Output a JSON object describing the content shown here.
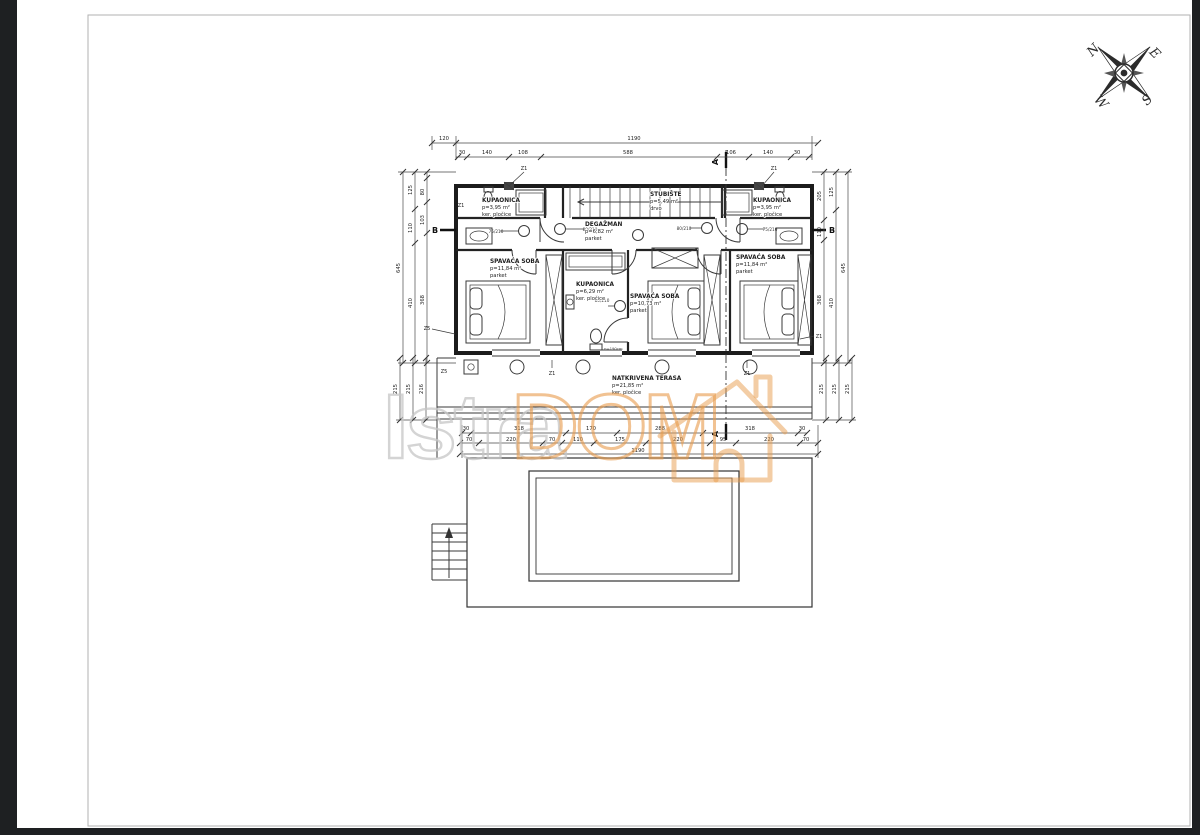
{
  "watermark": {
    "gray_text": "Istra",
    "orange_text": "DOM"
  },
  "colors": {
    "accent_orange": "#e89b4b",
    "watermark_gray": "#c6c6c6",
    "line": "#2a2a2a"
  },
  "compass": {
    "n": "N",
    "e": "E",
    "s": "S",
    "w": "W"
  },
  "sections": {
    "a": "A",
    "b": "B"
  },
  "rooms": {
    "bath_left": {
      "name": "KUPAONICA",
      "area": "p=3,95 m²",
      "floor": "ker. pločice"
    },
    "stairs": {
      "name": "STUBIŠTE",
      "area": "p=5,49 m²",
      "floor": "drvo"
    },
    "bath_right": {
      "name": "KUPAONICA",
      "area": "p=3,95 m²",
      "floor": "ker. pločice"
    },
    "hall": {
      "name": "DEGAŽMAN",
      "area": "p=6,82 m²",
      "floor": "parket"
    },
    "bedroom_left": {
      "name": "SPAVAĆA SOBA",
      "area": "p=11,84 m²",
      "floor": "parket"
    },
    "bath_mid": {
      "name": "KUPAONICA",
      "area": "p=6,29 m²",
      "floor": "ker. pločice"
    },
    "bedroom_mid": {
      "name": "SPAVAĆA SOBA",
      "area": "p=10,73 m²",
      "floor": "parket"
    },
    "bedroom_right": {
      "name": "SPAVAĆA SOBA",
      "area": "p=11,84 m²",
      "floor": "parket"
    },
    "terrace": {
      "name": "NATKRIVENA TERASA",
      "area": "p=21,85 m²",
      "floor": "ker. pločice"
    }
  },
  "openings": {
    "z1": "Z1",
    "z5": "Z5",
    "door_75": "75/210",
    "door_80": "80/210",
    "parapet": "p=190cm"
  },
  "dims": {
    "top_offset": "120",
    "total_width": "1190",
    "top_chain": [
      "30",
      "140",
      "108",
      "588",
      "106",
      "140",
      "30"
    ],
    "bottom_chain_a": [
      "30",
      "318",
      "170",
      "288",
      "318",
      "30"
    ],
    "bottom_chain_b": [
      "70",
      "220",
      "70",
      "110",
      "175",
      "220",
      "95",
      "220",
      "70"
    ],
    "bottom_total": "1190",
    "left_outer": "645",
    "left_mid": [
      "125",
      "110",
      "410"
    ],
    "left_inner": [
      "80",
      "103",
      "368"
    ],
    "left_lower": [
      "215",
      "215",
      "216"
    ],
    "right_outer": "645",
    "right_mid": [
      "125",
      "410"
    ],
    "right_inner": [
      "205",
      "110",
      "368"
    ],
    "right_lower": [
      "215",
      "215",
      "215"
    ]
  }
}
